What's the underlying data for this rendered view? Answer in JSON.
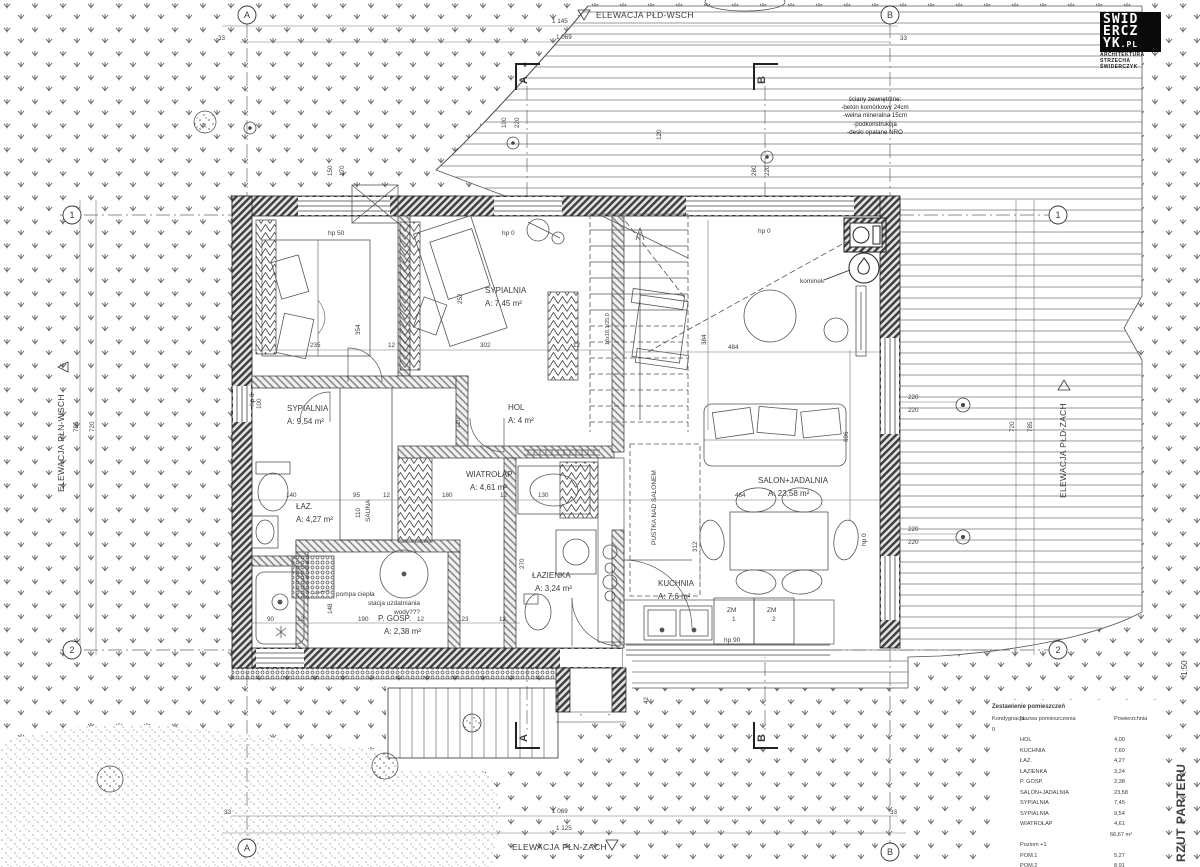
{
  "meta": {
    "sheet_title": "RZUT PARTERU",
    "scale": "1:50"
  },
  "logo": {
    "row1": "ŚWID",
    "row2": "ERCZ",
    "row3": "YK",
    "suffix": ".PL",
    "line1": "ARCHITEKTURA",
    "line2": "STRZECHA ŚWIDERCZYK"
  },
  "elevations": {
    "top": "ELEWACJA PŁD-WSCH",
    "left": "ELEWACJA PŁN-WSCH",
    "right": "ELEWACJA PŁD-ZACH",
    "bottom": "ELEWACJA PŁN-ZACH"
  },
  "notes": {
    "title": "ściany zewnętrzne:",
    "l1": "-beton komórkowy 24cm",
    "l2": "-wełna mineralna 15cm",
    "l3": "-podkonstrukcja",
    "l4": "-deski opalane NRO"
  },
  "grid": {
    "a": "A",
    "b": "B",
    "r1": "1",
    "r2": "2"
  },
  "rooms": [
    {
      "name": "SYPIALNIA",
      "area": "A: 9,54 m²"
    },
    {
      "name": "SYPIALNIA",
      "area": "A: 7,45 m²"
    },
    {
      "name": "HOL",
      "area": "A: 4 m²"
    },
    {
      "name": "WIATROŁAP",
      "area": "A: 4,61 m²"
    },
    {
      "name": "ŁAZ.",
      "area": "A: 4,27 m²"
    },
    {
      "name": "ŁAZIENKA",
      "area": "A: 3,24 m²"
    },
    {
      "name": "P. GOSP.",
      "area": "A: 2,38 m²"
    },
    {
      "name": "KUCHNIA",
      "area": "A: 7,6 m²"
    },
    {
      "name": "SALON+JADALNIA",
      "area": "A: 23,58 m²"
    },
    {
      "name": "SAUNA"
    },
    {
      "name": "PUSTKA NAD SALONEM"
    }
  ],
  "annotations": {
    "kominek": "kominek",
    "pompa": "pompa ciepła",
    "stacja1": "stacja uzdatniania",
    "stacja2": "wody???",
    "zm": "ZM",
    "zm1n": "1",
    "zm2n": "2",
    "hp0": "hp 0",
    "hp50": "hp 50",
    "hp90": "hp 90",
    "stairs": "16x18,1/25,0"
  },
  "dims": [
    "33",
    "1 145",
    "1 069",
    "33",
    "1 069",
    "1 125",
    "33",
    "33",
    "785",
    "720",
    "720",
    "785",
    "220",
    "220",
    "220",
    "220",
    "696",
    "384",
    "484",
    "464",
    "312",
    "235",
    "12",
    "302",
    "12",
    "354",
    "252",
    "140",
    "95",
    "12",
    "110",
    "130",
    "180",
    "12",
    "120",
    "90",
    "12",
    "190",
    "12",
    "123",
    "12",
    "148",
    "270",
    "42",
    "150",
    "170",
    "100",
    "220",
    "280",
    "220",
    "100",
    "120"
  ],
  "table": {
    "title": "Zestawienie pomieszczeń",
    "headers": {
      "kond": "Kondygnacja",
      "name": "Nazwa pomieszczenia",
      "area": "Powierzchnia"
    },
    "kond0": "0",
    "rows": [
      {
        "name": "HOL",
        "area": "4,00"
      },
      {
        "name": "KUCHNIA",
        "area": "7,60"
      },
      {
        "name": "ŁAZ.",
        "area": "4,27"
      },
      {
        "name": "ŁAZIENKA",
        "area": "3,24"
      },
      {
        "name": "P. GOSP.",
        "area": "2,38"
      },
      {
        "name": "SALON+JADALNIA",
        "area": "23,58"
      },
      {
        "name": "SYPIALNIA",
        "area": "7,45"
      },
      {
        "name": "SYPIALNIA",
        "area": "9,54"
      },
      {
        "name": "WIATROŁAP",
        "area": "4,61"
      }
    ],
    "subtotal0": "66,67 m²",
    "level1": "Poziom +1",
    "rows1": [
      {
        "name": "POM.1",
        "area": "5,27"
      },
      {
        "name": "POM.2",
        "area": "8,91"
      }
    ],
    "subtotal1": "14,18 m²",
    "total": "80,85 m²"
  }
}
